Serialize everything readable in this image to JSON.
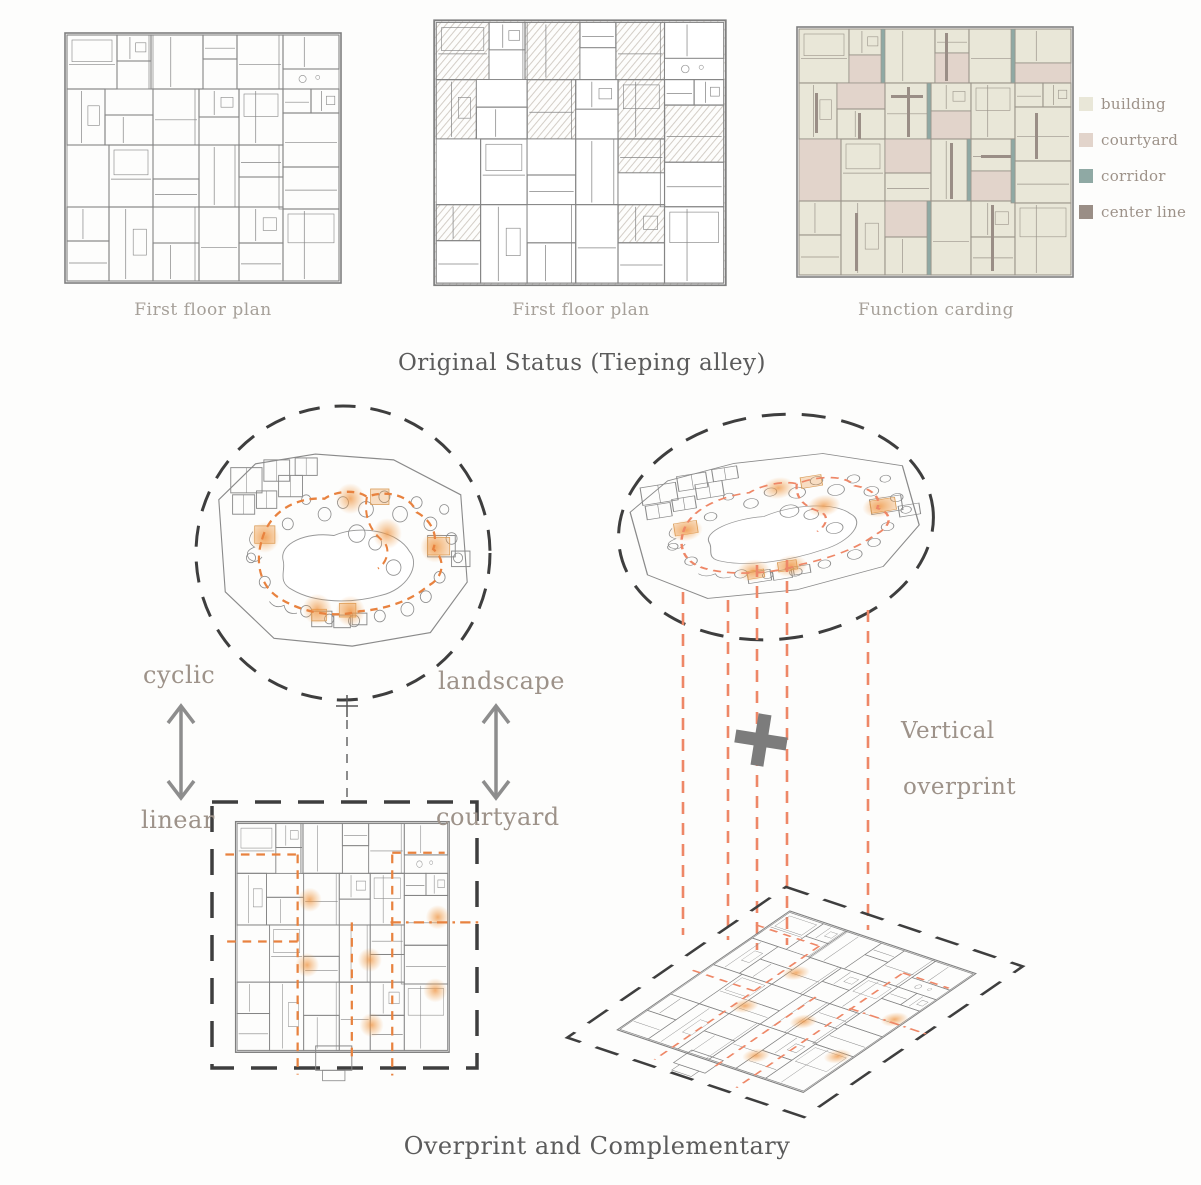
{
  "top": {
    "plans": [
      {
        "caption": "First floor plan"
      },
      {
        "caption": "First floor plan"
      },
      {
        "caption": "Function carding"
      }
    ],
    "legend": {
      "items": [
        {
          "label": "building",
          "color": "#e9e7d8"
        },
        {
          "label": "courtyard",
          "color": "#e2d4cb"
        },
        {
          "label": "corridor",
          "color": "#8fa9a4"
        },
        {
          "label": "center line",
          "color": "#9a8e86"
        }
      ]
    },
    "title": "Original Status (Tieping alley)"
  },
  "bottom": {
    "labels": {
      "top_left": "cyclic",
      "top_right": "landscape",
      "bottom_left": "linear",
      "bottom_right": "courtyard"
    },
    "vertical_label_line1": "Vertical",
    "vertical_label_line2": "overprint",
    "caption": "Overprint and Complementary"
  },
  "colors": {
    "plan_line": "#858585",
    "plan_line_light": "#9a9a9a",
    "building": "#e9e7d8",
    "courtyard": "#e2d4cb",
    "corridor": "#8fa9a4",
    "center_line": "#9a8e86",
    "dash_dark": "#3e3e3e",
    "arrow": "#8d8d8d",
    "orange": "#e8823f",
    "salmon": "#ee8767",
    "plus": "#7c7c7c"
  }
}
